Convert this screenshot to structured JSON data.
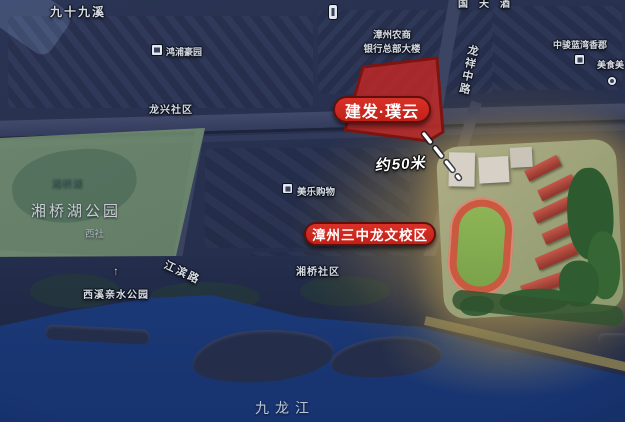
{
  "map": {
    "pills": {
      "project_label": "建发·璞云",
      "school_label": "漳州三中龙文校区"
    },
    "annotation": {
      "distance_label": "约50米"
    },
    "labels": {
      "stream_top_left": "九十九溪",
      "estate_hongpu": "鸿浦豪园",
      "community_longxing": "龙兴社区",
      "bank_line1": "漳州农商",
      "bank_line2": "银行总部大楼",
      "road_longxiang": "龙祥中路",
      "top_edge_partial": "国天酒",
      "estate_zhongjun": "中骏蓝湾香郡",
      "food_street_partial": "美食美",
      "mall_meile": "美乐购物",
      "community_xiangqiao": "湘桥社区",
      "lake_xiangqiao": "湘桥湖",
      "park_xiangqiaohu": "湘桥湖公园",
      "village_xishe": "西社",
      "park_xixi": "西溪亲水公园",
      "road_jiangbin": "江滨路",
      "river_jiulong": "九龙江"
    },
    "icons": {
      "arrow_up_glyph": "↑"
    },
    "colors": {
      "marker_red": "#ce2a22",
      "marker_border": "#5f100d",
      "site_fill": "#cb2722",
      "site_stroke": "#7e1410",
      "park_green": "#74946e",
      "river_blue": "#1f4080",
      "base_navy": "#27304e",
      "school_glow": "#c8a050"
    }
  }
}
